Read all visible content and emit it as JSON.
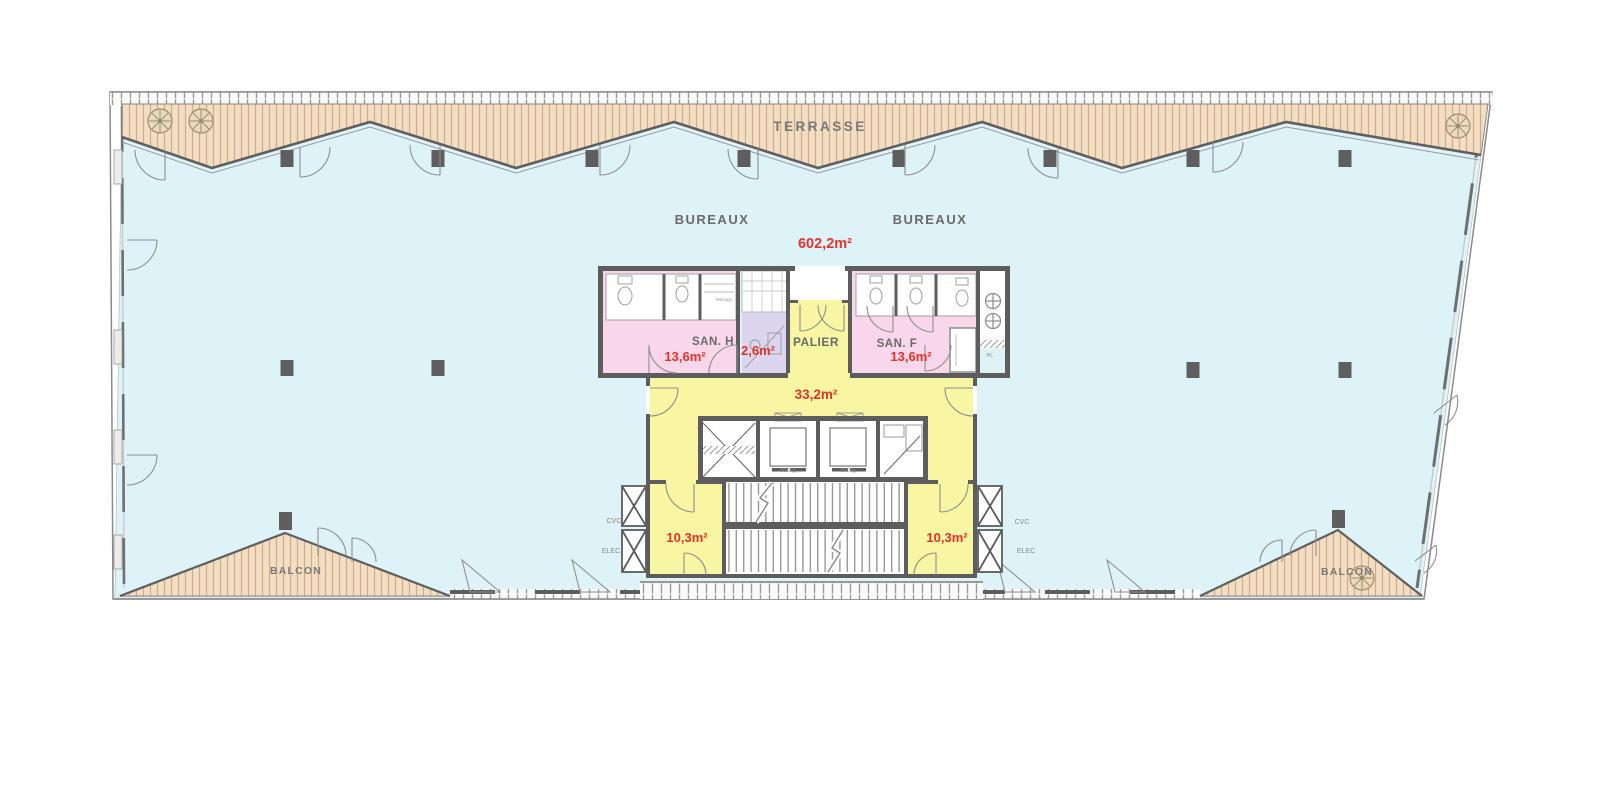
{
  "floorplan": {
    "terrace": {
      "label": "TERRASSE"
    },
    "offices": {
      "label_left": "BUREAUX",
      "label_right": "BUREAUX",
      "area": "602,2m²"
    },
    "sanitary_men": {
      "label": "SAN. H",
      "area": "13,6m²"
    },
    "cleaning_closet": {
      "label": "Ménage"
    },
    "duct_room": {
      "area": "2,6m²"
    },
    "landing": {
      "label": "PALIER",
      "area": "33,2m²"
    },
    "sanitary_women": {
      "label": "SAN. F",
      "area": "13,6m²"
    },
    "stairwell_left": {
      "area": "10,3m²"
    },
    "stairwell_right": {
      "area": "10,3m²"
    },
    "balcony_left": {
      "label": "BALCON"
    },
    "balcony_right": {
      "label": "BALCON"
    },
    "shafts": {
      "cvc": "CVC",
      "elec": "ELEC"
    },
    "elevator": {
      "capacity": "800kg"
    },
    "closet": {
      "label": "PL"
    },
    "colors": {
      "office_floor": "#ddf3f7",
      "terrace_deck": "#f3dec4",
      "core_landing": "#f8f5a3",
      "sanitary": "#f8d7ea",
      "technical": "#dbd5ee",
      "wall": "#5d5d5d",
      "area_text": "#e2332b",
      "label_text": "#6a6a6a"
    }
  }
}
